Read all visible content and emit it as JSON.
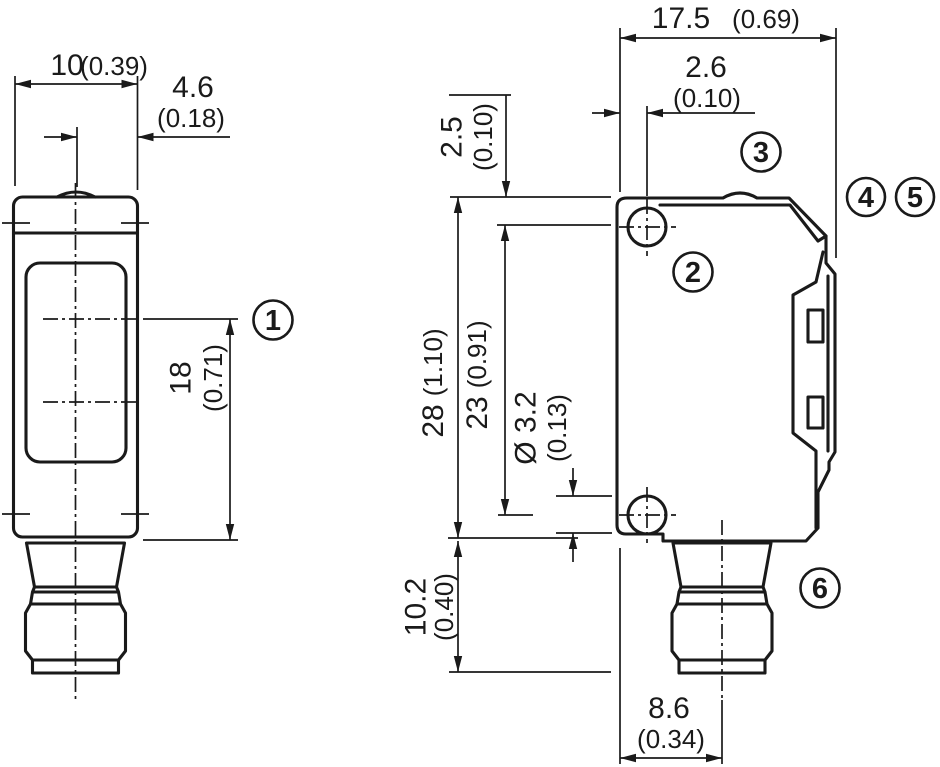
{
  "drawing": {
    "type": "technical-dimension-drawing",
    "colors": {
      "line": "#1a1a1a",
      "background": "#ffffff"
    },
    "dims": {
      "front_width_mm": "10",
      "front_width_in": "(0.39)",
      "axis_offset_mm": "4.6",
      "axis_offset_in": "(0.18)",
      "beam_to_bottom_mm": "18",
      "beam_to_bottom_in": "(0.71)",
      "depth_mm": "17.5",
      "depth_in": "(0.69)",
      "hole_edge_mm": "2.6",
      "hole_edge_in": "(0.10)",
      "top_hole_mm": "2.5",
      "top_hole_in": "(0.10)",
      "height_mm": "28",
      "height_in": "(1.10)",
      "hole_spacing_mm": "23",
      "hole_spacing_in": "(0.91)",
      "hole_dia_mm": "Ø 3.2",
      "hole_dia_in": "(0.13)",
      "connector_len_mm": "10.2",
      "connector_len_in": "(0.40)",
      "connector_off_mm": "8.6",
      "connector_off_in": "(0.34)"
    },
    "callouts": {
      "c1": "1",
      "c2": "2",
      "c3": "3",
      "c4": "4",
      "c5": "5",
      "c6": "6"
    }
  }
}
